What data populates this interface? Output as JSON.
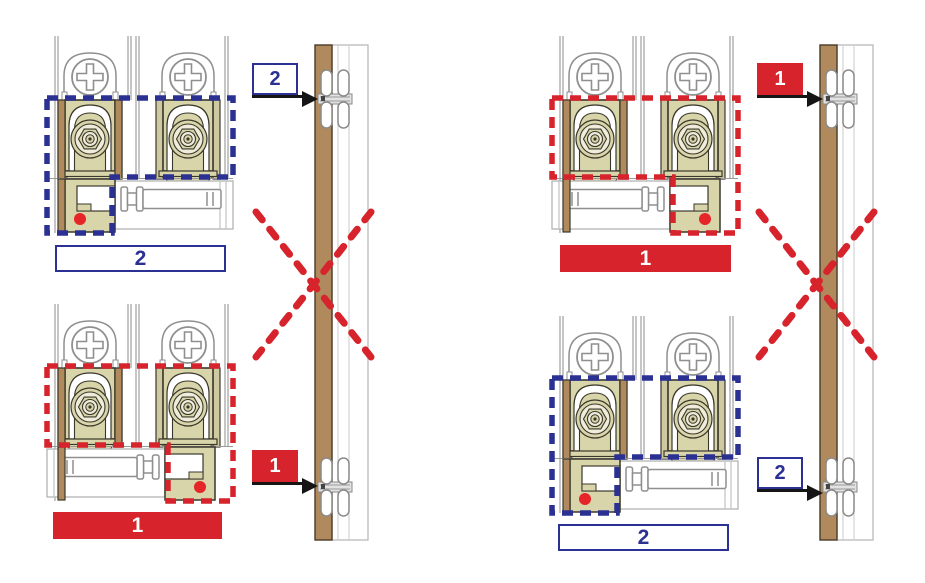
{
  "colors": {
    "navy": "#2b3192",
    "red": "#d7232b",
    "marker_dot_red": "#e52528",
    "wood_brown": "#b08a5c",
    "carriage_khaki": "#d9d5aa",
    "carriage_cream": "#efedda",
    "outline_dark": "#3a372c",
    "metal_gray": "#8f8f8f",
    "arrow_black": "#151515",
    "white": "#ffffff"
  },
  "quadrants": {
    "top_left": {
      "step_label": "2",
      "label_style": "outline-navy",
      "outline_color": "navy",
      "bracket_side": "left",
      "marker_dot": "red"
    },
    "bottom_left": {
      "step_label": "1",
      "label_style": "solid-red",
      "outline_color": "red",
      "bracket_side": "right",
      "marker_dot": "red"
    },
    "top_right": {
      "step_label": "1",
      "label_style": "solid-red",
      "outline_color": "red",
      "bracket_side": "right",
      "marker_dot": "red"
    },
    "bottom_right": {
      "step_label": "2",
      "label_style": "outline-navy",
      "outline_color": "navy",
      "bracket_side": "left",
      "marker_dot": "red"
    }
  },
  "door_callouts": {
    "left_top": {
      "label": "2",
      "style": "outline-navy"
    },
    "left_bottom": {
      "label": "1",
      "style": "solid-red"
    },
    "right_top": {
      "label": "1",
      "style": "solid-red"
    },
    "right_bottom": {
      "label": "2",
      "style": "outline-navy"
    }
  },
  "icons": {
    "roller_carriage": "sliding-door-roller-carriage",
    "phillips_screw": "phillips-screw-head",
    "concealed_hinge": "concealed-hinge",
    "prohibition_mark": "red-dashed-cross",
    "marker_dot": "red-dot",
    "callout_arrow": "black-arrow-right"
  }
}
